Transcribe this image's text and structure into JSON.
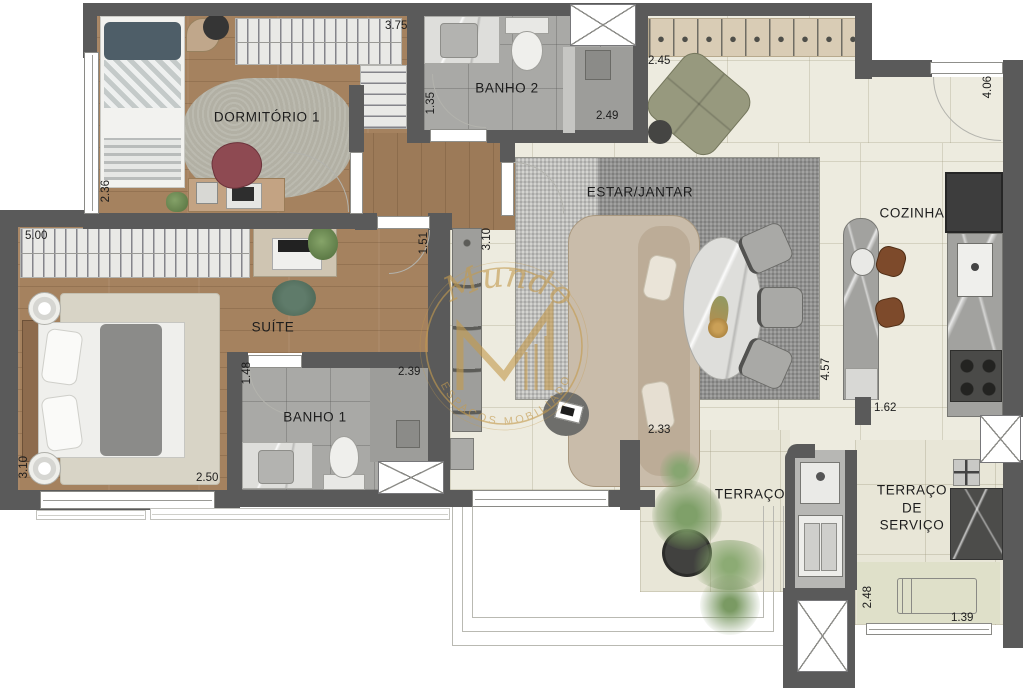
{
  "plan": {
    "title": "Planta do apartamento",
    "rooms": {
      "dormitorio1": "DORMITÓRIO 1",
      "banho2": "BANHO 2",
      "suite": "SUÍTE",
      "banho1": "BANHO 1",
      "estar_jantar": "ESTAR/JANTAR",
      "cozinha": "COZINHA",
      "terraco": "TERRAÇO",
      "terraco_servico": "TERRAÇO DE SERVIÇO"
    },
    "dimensions": {
      "dorm_top": "3.75",
      "hall_top": "1.35",
      "banho2_width": "2.49",
      "entry_width": "2.45",
      "kitchen_height": "4.06",
      "dorm_left": "2.36",
      "suite_wardrobe": "5.00",
      "hall_height": "1.51",
      "estar_left": "3.10",
      "suite_left": "3.10",
      "suite_bottom": "2.50",
      "banho1_left": "1.48",
      "banho1_width": "2.39",
      "sofa_bottom": "2.33",
      "peninsula_height": "4.57",
      "kitchen_pass": "1.62",
      "servico_left": "2.48",
      "servico_bottom": "1.39"
    },
    "watermark": {
      "script_text": "Mundo",
      "monogram": "M",
      "arc_text": "ESPAÇOS MOBILIADOS"
    },
    "colors": {
      "wall": "#5a5a5a",
      "watermark_gold": "#c49b4f",
      "wood_floor": "#a5825f",
      "tile_floor": "#edebdf",
      "bath_floor": "#a9a9a6"
    }
  }
}
